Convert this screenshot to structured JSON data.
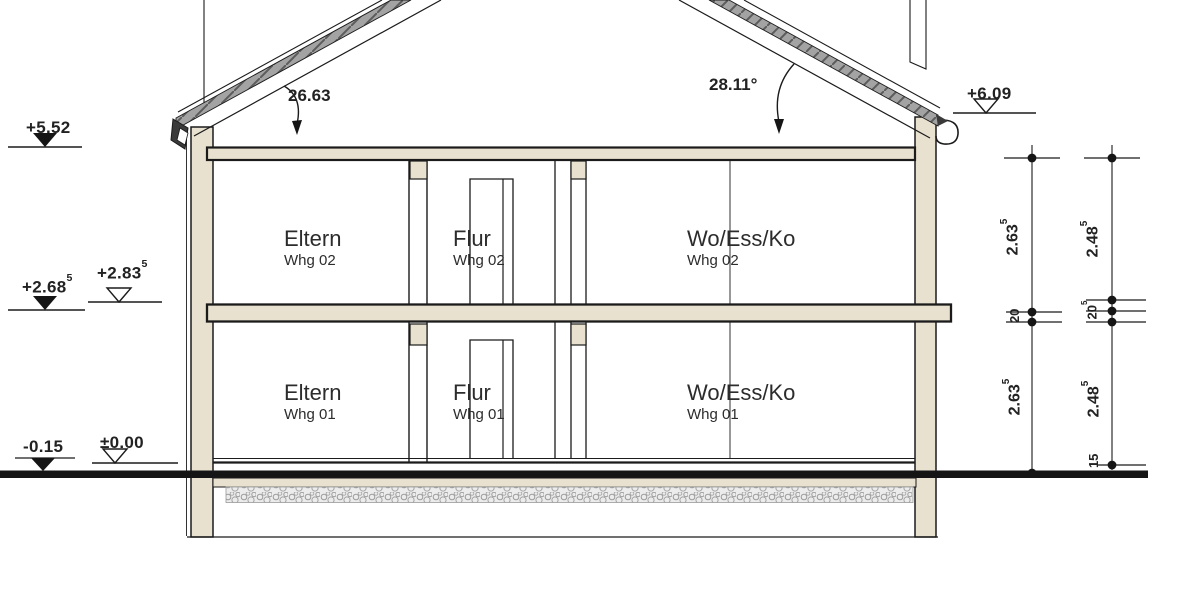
{
  "drawing": {
    "type": "building-cross-section",
    "angles": {
      "left": "26.63",
      "right": "28.11°"
    },
    "levels": {
      "roof_left": {
        "value": "+5.52",
        "marker": "filled"
      },
      "mid_raw": {
        "value": "+2.68",
        "sup": "5",
        "marker": "filled"
      },
      "mid_fin": {
        "value": "+2.83",
        "sup": "5",
        "marker": "open"
      },
      "ground_raw": {
        "value": "-0.15",
        "marker": "filled"
      },
      "ground_fin": {
        "value": "±0.00",
        "marker": "open"
      },
      "eave_right": {
        "value": "+6.09",
        "marker": "open"
      }
    },
    "rooms": {
      "upper_left": {
        "name": "Eltern",
        "unit": "Whg 02"
      },
      "upper_mid": {
        "name": "Flur",
        "unit": "Whg 02"
      },
      "upper_right": {
        "name": "Wo/Ess/Ko",
        "unit": "Whg 02"
      },
      "lower_left": {
        "name": "Eltern",
        "unit": "Whg 01"
      },
      "lower_mid": {
        "name": "Flur",
        "unit": "Whg 01"
      },
      "lower_right": {
        "name": "Wo/Ess/Ko",
        "unit": "Whg 01"
      }
    },
    "dimensions": {
      "left_upper": {
        "value": "2.63",
        "sup": "5"
      },
      "left_slab": {
        "value": "20"
      },
      "left_lower": {
        "value": "2.63",
        "sup": "5"
      },
      "right_upper": {
        "value": "2.48",
        "sup": "5"
      },
      "right_slab": {
        "value": "20",
        "sup": "5"
      },
      "right_lower": {
        "value": "2.48",
        "sup": "5"
      },
      "right_base": {
        "value": "15"
      }
    },
    "colors": {
      "wall_fill": "#e9e1cf",
      "line": "#1b1b1b",
      "tile_fill": "#a3a3a3",
      "ground": "#151515"
    }
  }
}
